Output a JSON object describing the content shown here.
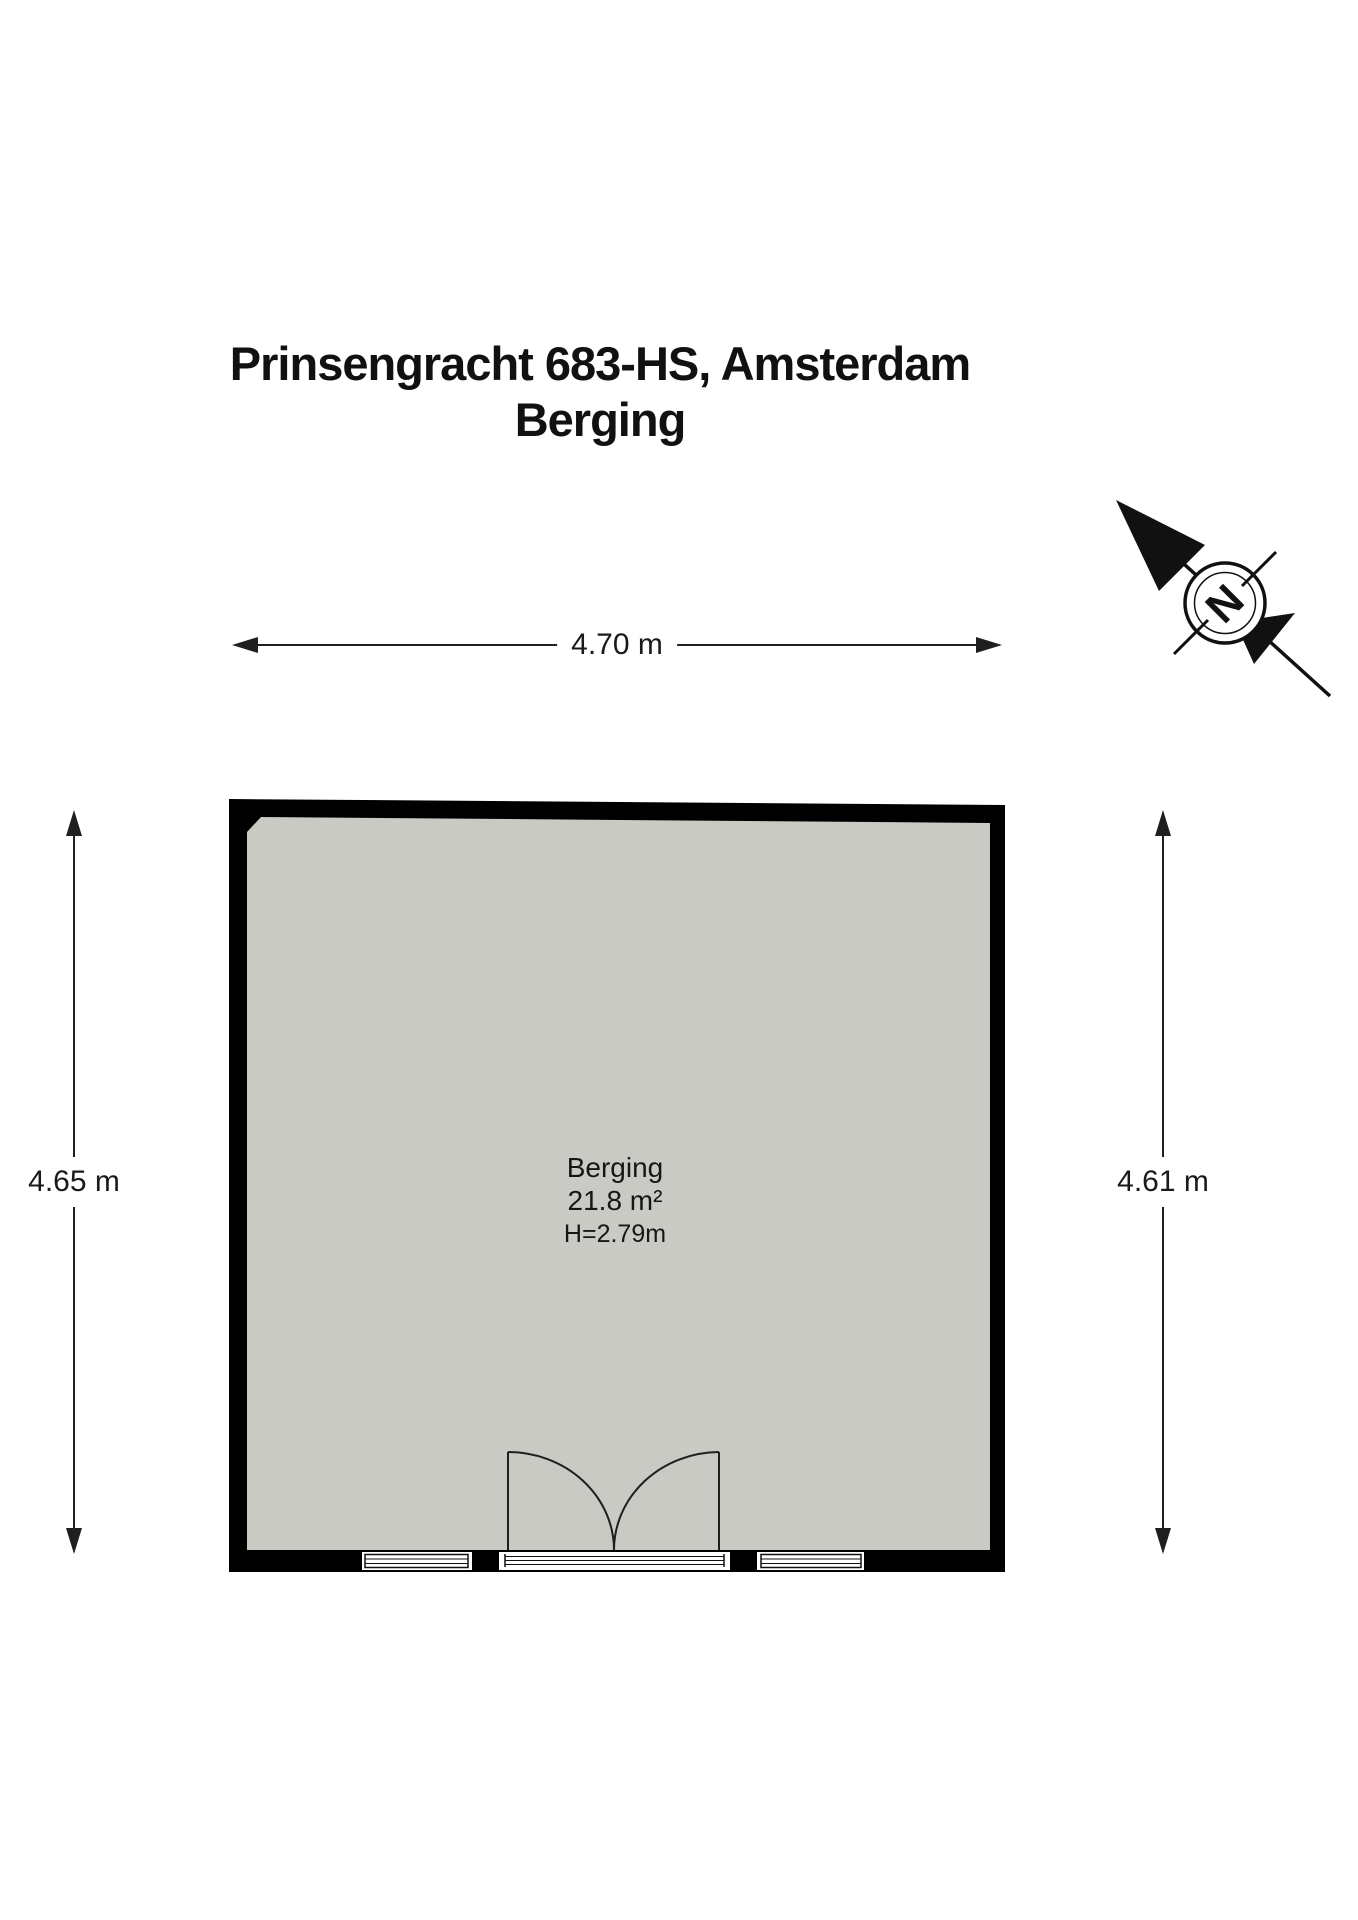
{
  "title": {
    "line1": "Prinsengracht 683-HS, Amsterdam",
    "line2": "Berging"
  },
  "compass": {
    "letter": "N"
  },
  "dimensions": {
    "width_top": "4.70 m",
    "height_left": "4.65 m",
    "height_right": "4.61 m"
  },
  "room": {
    "name": "Berging",
    "area": "21.8 m²",
    "ceiling_height": "H=2.79m"
  },
  "colors": {
    "wall": "#000000",
    "floor": "#c8cac3",
    "line": "#1f1f1f",
    "text": "#111111",
    "background": "#ffffff"
  }
}
